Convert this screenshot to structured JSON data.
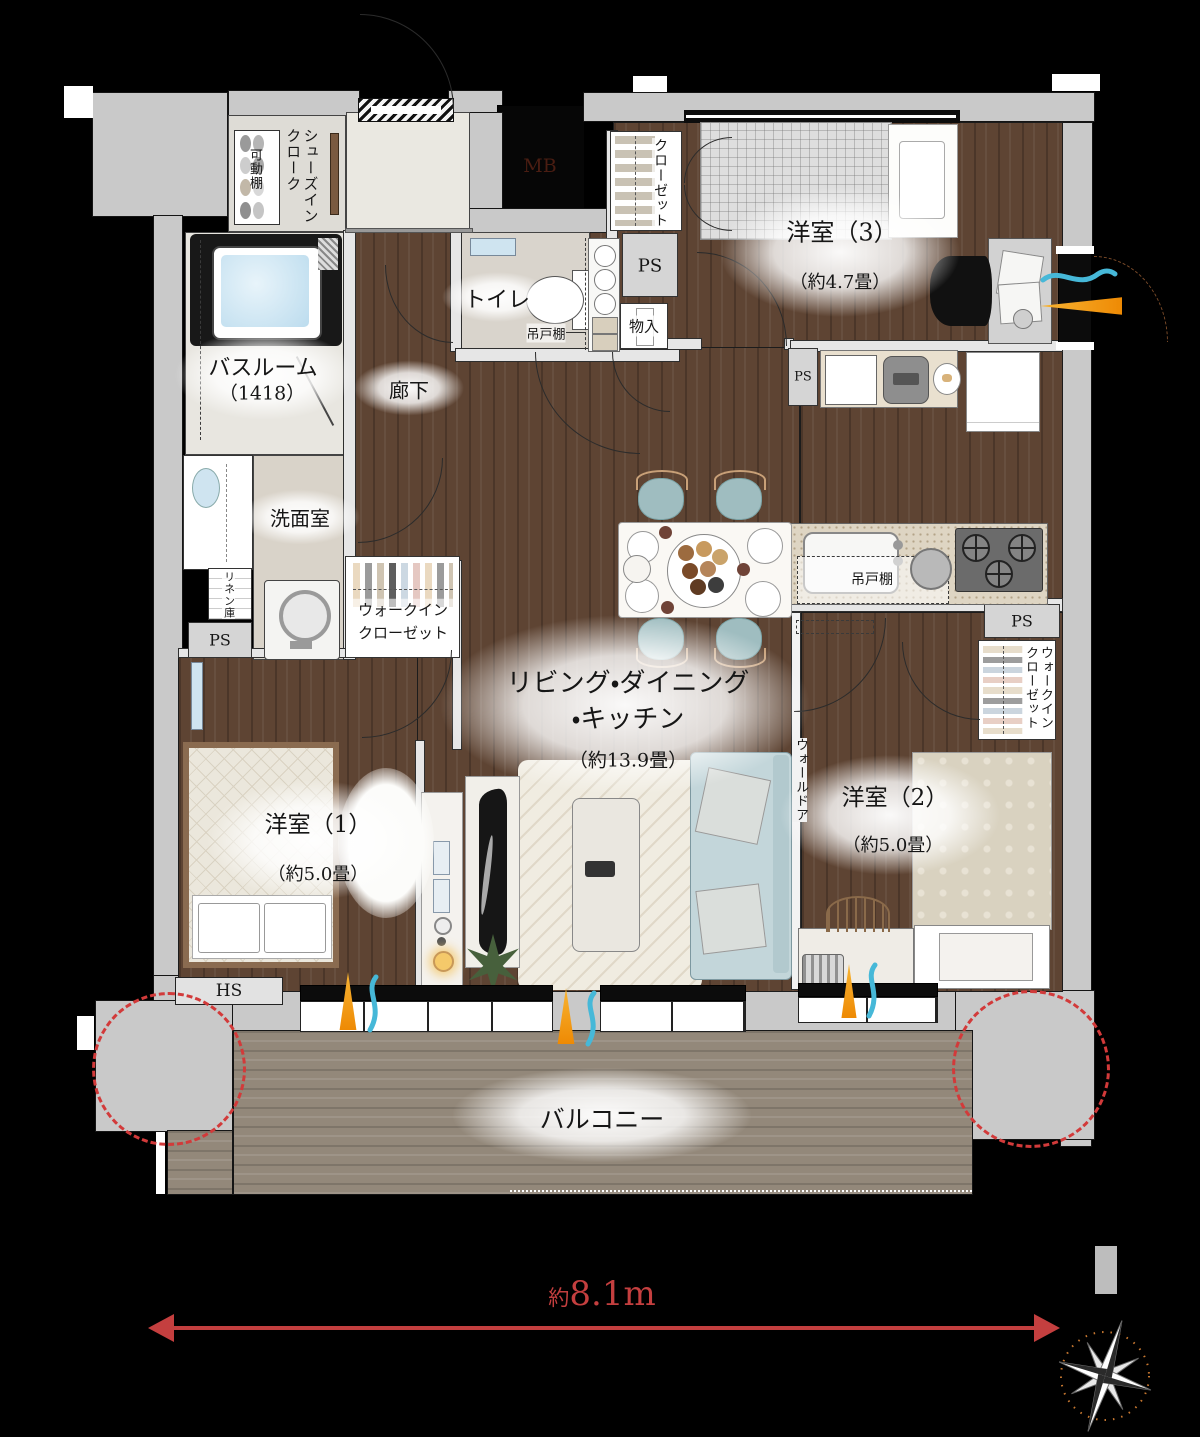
{
  "plan": {
    "labels": {
      "genkan": "玄関",
      "shoes_cloak": "シューズインクローク",
      "movable_shelf": "可動棚",
      "bathroom": "バスルーム",
      "bathroom_size": "（1418）",
      "washroom": "洗面室",
      "linen": "リネン庫",
      "ps": "PS",
      "toilet": "トイレ",
      "hanging_cupboard": "吊戸棚",
      "hallway": "廊下",
      "storage": "物入",
      "closet": "クローゼット",
      "room3": "洋室（3）",
      "room3_size": "（約4.7畳）",
      "ldk_line1": "リビング・ダイニング",
      "ldk_line2": "・キッチン",
      "ldk_size": "（約13.9畳）",
      "wic": "ウォークインクローゼット",
      "wall_door": "ウォールドア",
      "room2": "洋室（2）",
      "room2_size": "（約5.0畳）",
      "room1": "洋室（1）",
      "room1_size": "（約5.0畳）",
      "hs": "HS",
      "mb": "MB",
      "balcony": "バルコニー",
      "width_dim": "約8.1m"
    },
    "colors": {
      "wall_gray": "#c9c9c9",
      "wood_floor": "#5e4433",
      "balcony_floor": "#93887a",
      "accent_red": "#c43f3f",
      "flame_orange": "#ee8a04",
      "wave_teal": "#46b8d8"
    }
  }
}
